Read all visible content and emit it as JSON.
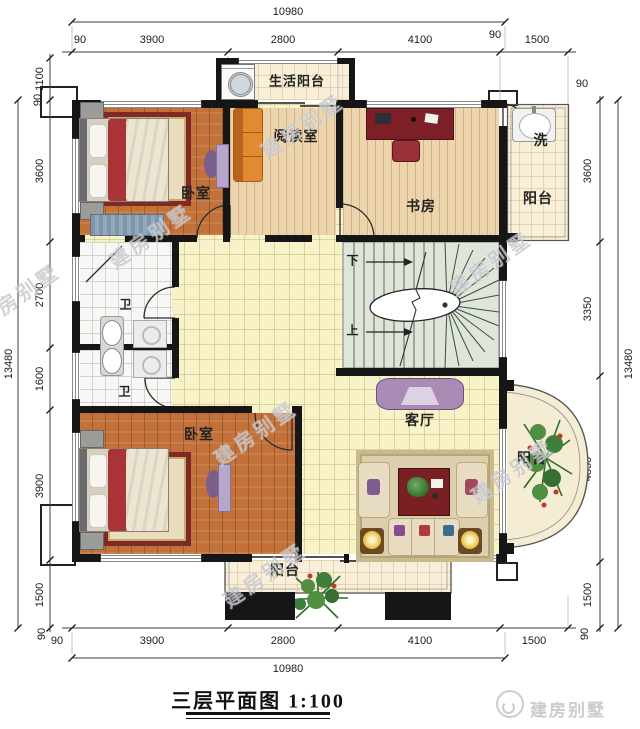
{
  "watermark": "建房别墅",
  "title": "三层平面图 1:100",
  "brand": "建房别墅",
  "rooms": {
    "life_balcony": "生活阳台",
    "bedroom_top": "卧室",
    "reading_room": "阅读室",
    "study": "书房",
    "wash": "洗",
    "balcony_top_right": "阳台",
    "wc_upper": "卫",
    "wc_lower": "卫",
    "bedroom_bottom": "卧室",
    "living_room": "客厅",
    "balcony_right": "阳台",
    "balcony_bottom": "阳台"
  },
  "stairs": {
    "down": "下",
    "up": "上"
  },
  "dims": {
    "top": {
      "total": "10980",
      "row": [
        "90",
        "3900",
        "2800",
        "4100",
        "90",
        "1500"
      ]
    },
    "bottom": {
      "total": "10980",
      "row": [
        "90",
        "3900",
        "2800",
        "4100",
        "1500"
      ]
    },
    "left": {
      "total": "13480",
      "row": [
        "1100",
        "90",
        "3600",
        "2700",
        "1600",
        "3900",
        "1500",
        "90"
      ]
    },
    "right": {
      "total": "13480",
      "row": [
        "90",
        "3600",
        "3350",
        "4850",
        "1500",
        "90"
      ]
    }
  },
  "colors": {
    "wall": "#161616",
    "wood_floor": "#c2713a",
    "pale_wood_floor": "#ecd5ac",
    "hall_tile": "#f7f2c8",
    "balcony_tile": "#f9efd8",
    "stair_tread": "#dde6d9",
    "sofa_orange": "#d9822b",
    "table_red": "#7a1f24",
    "furniture_purple": "#a98bb5",
    "watermark_gray": "#acacb4"
  }
}
